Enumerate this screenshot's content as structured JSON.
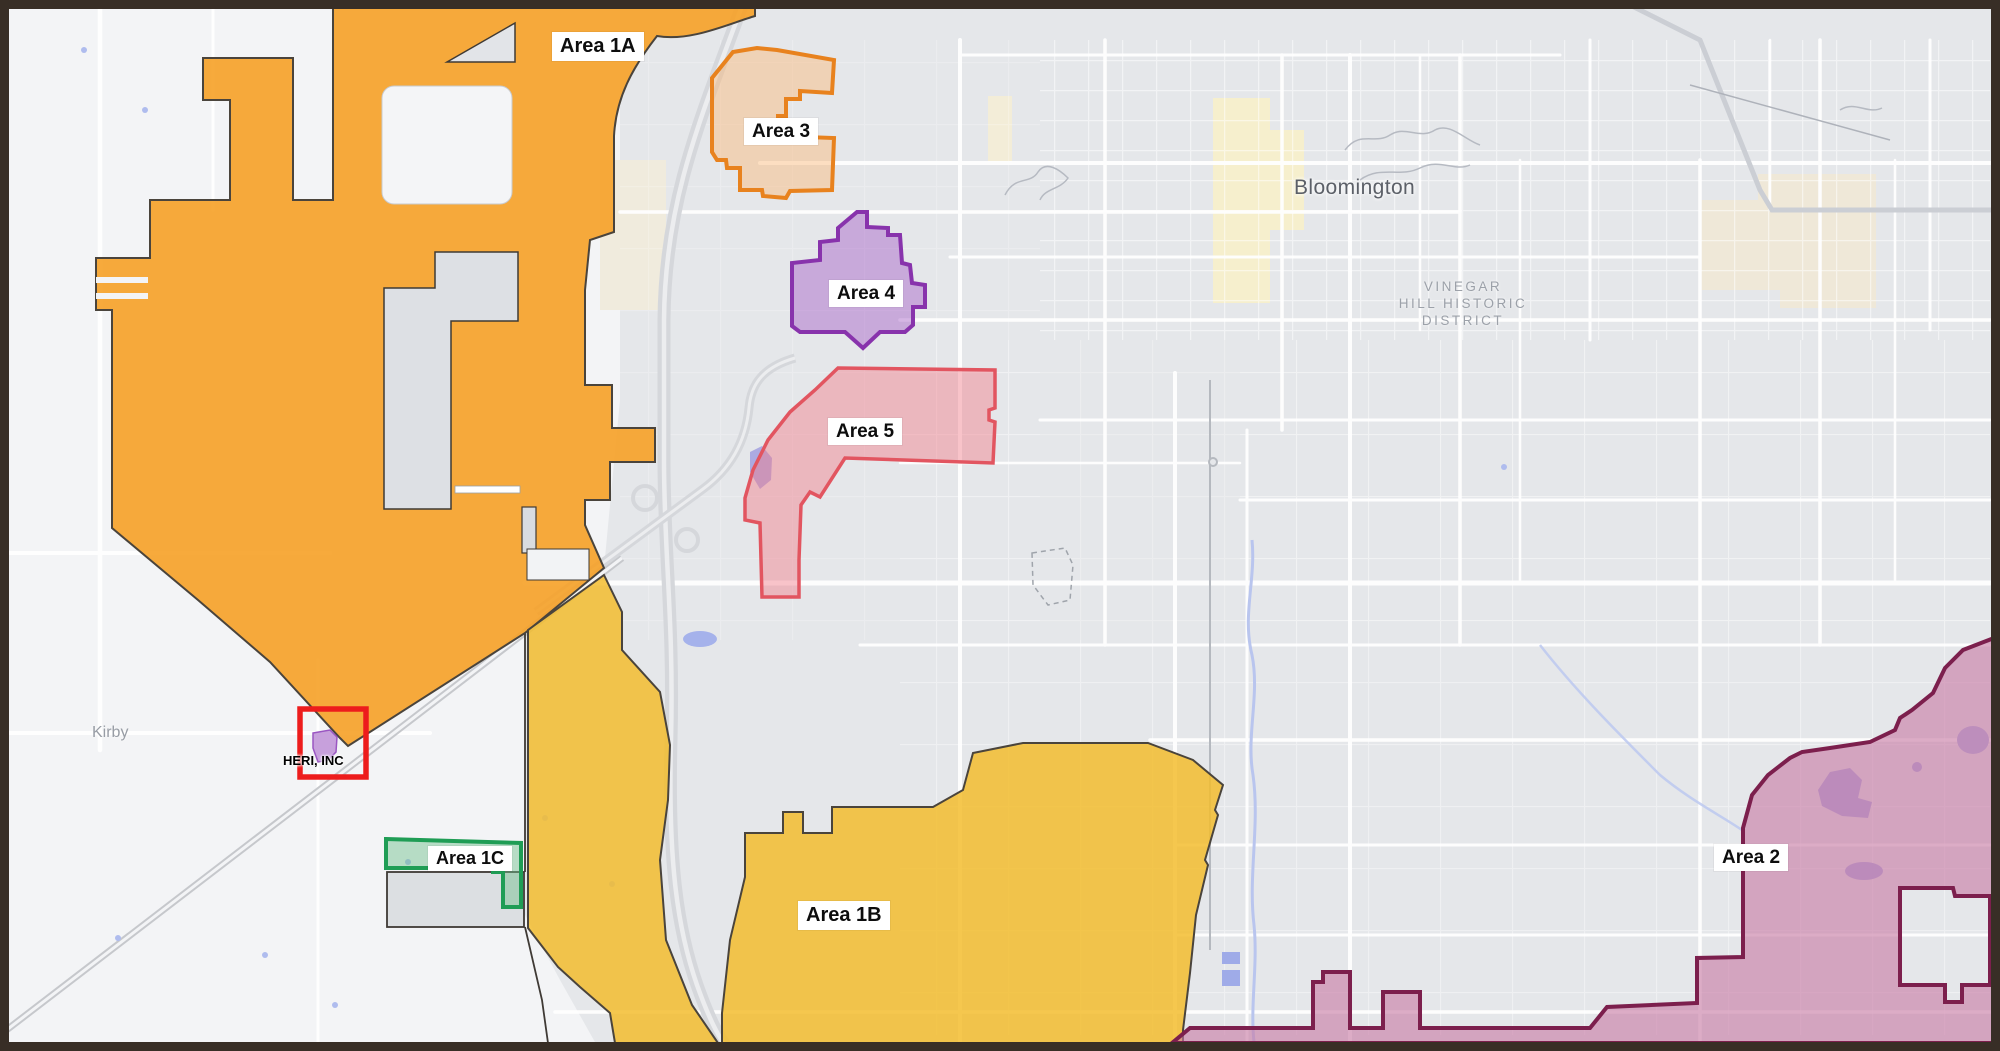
{
  "map": {
    "title_labels": {
      "city": "Bloomington",
      "district": "VINEGAR\nHILL HISTORIC\nDISTRICT",
      "town": "Kirby"
    },
    "areas": {
      "a1a": {
        "label": "Area 1A",
        "fill": "rgba(246,161,39,0.90)",
        "stroke": "#4A443C"
      },
      "a1b": {
        "label": "Area 1B",
        "fill": "rgba(243,188,44,0.84)",
        "stroke": "#4A443C"
      },
      "a1c": {
        "label": "Area 1C",
        "fill": "rgba(108,190,138,0.45)",
        "stroke": "#1F9D55"
      },
      "a2": {
        "label": "Area 2",
        "fill": "rgba(200,123,164,0.62)",
        "stroke": "#7C1F4D"
      },
      "a3": {
        "label": "Area 3",
        "fill": "rgba(250,185,120,0.45)",
        "stroke": "#E8821E"
      },
      "a4": {
        "label": "Area 4",
        "fill": "rgba(169,102,201,0.48)",
        "stroke": "#8833AC"
      },
      "a5": {
        "label": "Area 5",
        "fill": "rgba(242,125,138,0.45)",
        "stroke": "#E25560"
      }
    },
    "site": {
      "label": "HERI, INC",
      "box_color": "#ED1C1C",
      "marker_fill": "#C7A0DC"
    }
  }
}
